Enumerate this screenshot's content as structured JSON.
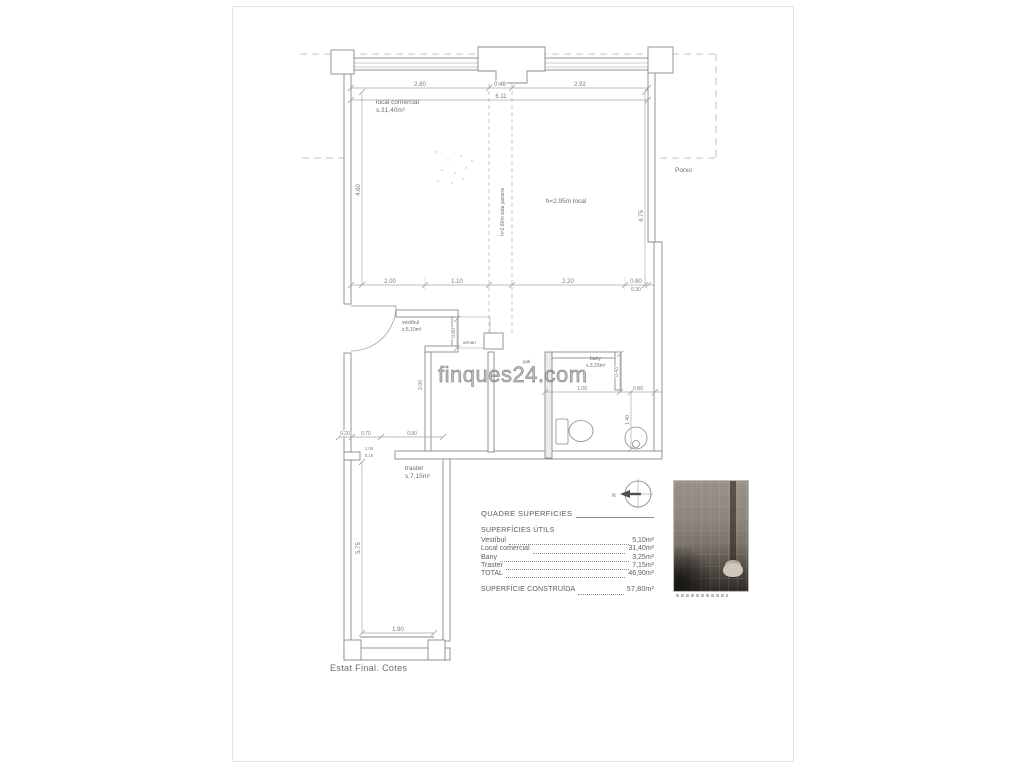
{
  "watermark": {
    "text": "finques24.com"
  },
  "plan": {
    "rooms": {
      "local_comercial": {
        "name": "local comercial",
        "area": "s.31,40m²"
      },
      "vestibul": {
        "name": "vestíbul",
        "area": "s.5,10m²"
      },
      "bany": {
        "name": "bany",
        "area": "s.3,25m²"
      },
      "traster": {
        "name": "traster",
        "area": "s.7,15m²"
      },
      "pati": {
        "name": "pati"
      },
      "armari": {
        "name": "armari"
      },
      "porxo": {
        "name": "Porxo"
      }
    },
    "annotations": {
      "height_local": "h=2.95m local",
      "height_beam": "h=2.60m sota jassera",
      "north": "N",
      "footer": "Estat Final. Cotes"
    },
    "dims": {
      "top_left": "2.80",
      "top_center": "0.46",
      "top_right": "2.92",
      "top_total": "6.11",
      "left_height": "4.60",
      "right_height": "4.75",
      "right_step": "0.30",
      "mid_1": "2.00",
      "mid_2": "1.10",
      "mid_3": "2.20",
      "mid_4": "0.80",
      "closet_width": "0.80",
      "vestibul_height": "2.00",
      "bany_width": "1.00",
      "bany_right": "0.80",
      "bany_v_small": "0.43",
      "bany_v": "1.40",
      "traster_1": "0.20",
      "traster_2": "0.70",
      "traster_3": "0.90",
      "jamb_1": "1.05",
      "jamb_2": "0.16",
      "traster_height": "5.75",
      "traster_width": "1.90"
    }
  },
  "surface_table": {
    "title": "QUADRE SUPERFICIES",
    "section": "SUPERFÍCIES ÚTILS",
    "rows": [
      {
        "label": "Vestíbul",
        "value": "5,10m²"
      },
      {
        "label": "Local comercial",
        "value": "31,40m²"
      },
      {
        "label": "Bany",
        "value": "3,25m²"
      },
      {
        "label": "Traster",
        "value": "7,15m²"
      },
      {
        "label": "TOTAL",
        "value": "46,90m²"
      }
    ],
    "constructed": {
      "label": "SUPERFÍCIE CONSTRUÏDA",
      "value": "57,80m²"
    }
  }
}
